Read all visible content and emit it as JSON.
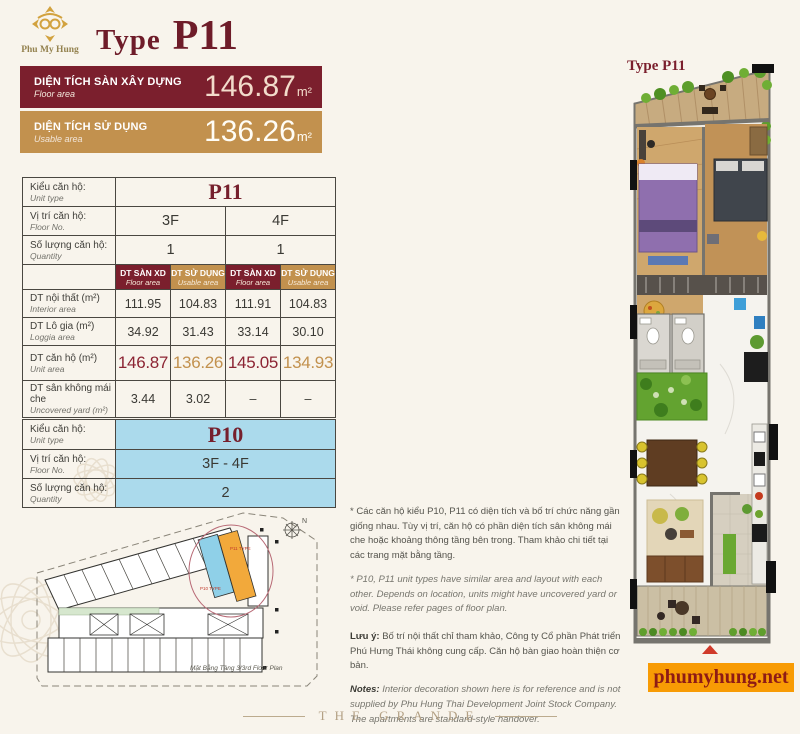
{
  "brand": {
    "logo_text": "Phu My Hung",
    "website": "phumyhung.net",
    "footer_brand": "THE GRANDE"
  },
  "header": {
    "title_prefix": "Type",
    "title_code": "P11"
  },
  "bars": {
    "floor": {
      "vi": "DIỆN TÍCH SÀN XÂY DỰNG",
      "en": "Floor area",
      "value": "146.87",
      "unit": "m²",
      "bg": "#7b1f2d"
    },
    "usable": {
      "vi": "DIỆN TÍCH SỬ DỤNG",
      "en": "Usable area",
      "value": "136.26",
      "unit": "m²",
      "bg": "#c2914e"
    }
  },
  "labels": {
    "unit_type_vi": "Kiểu căn hộ:",
    "unit_type_en": "Unit type",
    "floor_no_vi": "Vị trí căn hộ:",
    "floor_no_en": "Floor No.",
    "quantity_vi": "Số lượng căn hộ:",
    "quantity_en": "Quantity"
  },
  "t1": {
    "unit_type": "P11",
    "floors": [
      "3F",
      "4F"
    ],
    "quantities": [
      "1",
      "1"
    ],
    "headers": [
      {
        "vi": "DT SÀN XD",
        "en": "Floor area"
      },
      {
        "vi": "DT SỬ DỤNG",
        "en": "Usable area"
      },
      {
        "vi": "DT SÀN XD",
        "en": "Floor area"
      },
      {
        "vi": "DT SỬ DỤNG",
        "en": "Usable area"
      }
    ],
    "rows": [
      {
        "vi": "DT nội thất (m²)",
        "en": "Interior area",
        "values": [
          "111.95",
          "104.83",
          "111.91",
          "104.83"
        ]
      },
      {
        "vi": "DT Lô gia (m²)",
        "en": "Loggia area",
        "values": [
          "34.92",
          "31.43",
          "33.14",
          "30.10"
        ]
      },
      {
        "vi": "DT căn hộ (m²)",
        "en": "Unit area",
        "values": [
          "146.87",
          "136.26",
          "145.05",
          "134.93"
        ]
      },
      {
        "vi": "DT sân không mái che",
        "en": "Uncovered yard (m²)",
        "values": [
          "3.44",
          "3.02",
          "–",
          "–"
        ]
      }
    ]
  },
  "t2": {
    "unit_type": "P10",
    "floor": "3F - 4F",
    "quantity": "2"
  },
  "notes": {
    "vi_para": "* Các căn hộ kiểu P10, P11 có diện tích và bố trí chức năng gần giống nhau. Tùy vị trí, căn hộ có phần diện tích sân không mái che hoặc khoảng thông tầng bên trong. Tham khảo chi tiết tại các trang mặt bằng tầng.",
    "en_para": "* P10, P11 unit types have similar area and layout with each other. Depends on location, units might have uncovered yard or void. Please refer pages of floor plan.",
    "note_vi_label": "Lưu ý:",
    "note_vi_text": " Bố trí nội thất chỉ tham khảo, Công ty Cổ phần Phát triển Phú Hưng Thái không cung cấp. Căn hộ bàn giao hoàn thiện cơ bản.",
    "note_en_label": "Notes:",
    "note_en_text": " Interior decoration shown here is for reference and is not supplied by Phu Hung Thai Development Joint Stock Company. The apartments are standard-style handover."
  },
  "overview": {
    "caption": "Mặt Bằng Tầng 3/3rd Floor Plan",
    "compass": "N",
    "p10_tag": "P10 TYPE",
    "p11_tag": "P11 TYPE"
  },
  "detail": {
    "title": "Type P11"
  },
  "colors": {
    "maroon": "#7b1f2d",
    "tan": "#c2914e",
    "unit_blue": "#abdaec",
    "unit_orange": "#f2a93b",
    "site_orange": "#f89b04"
  }
}
